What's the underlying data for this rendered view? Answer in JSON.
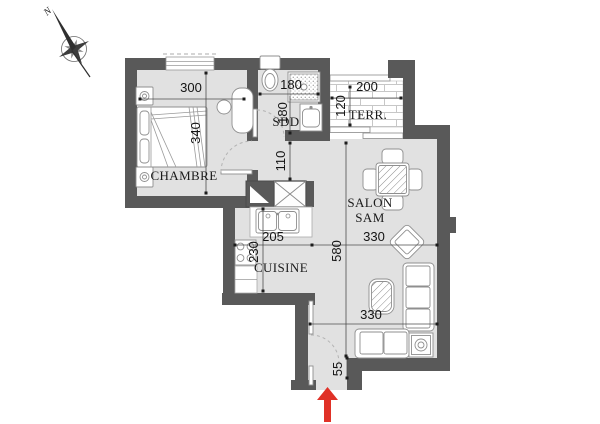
{
  "title": "apartment floor plan",
  "colors": {
    "wall": "#595959",
    "floor": "#e1e1e1",
    "fixture_stroke": "#8f8f8f",
    "dimension_text": "#141414",
    "entry_arrow": "#e03127"
  },
  "compass": {
    "north": "N"
  },
  "rooms": {
    "chambre": {
      "label": "CHAMBRE",
      "width_cm": "300",
      "height_cm": "340"
    },
    "sdd": {
      "label": "SDD",
      "width_cm": "180",
      "height_cm": "180"
    },
    "terrace": {
      "label": "TERR.",
      "width_cm": "200",
      "height_cm": "120"
    },
    "salon": {
      "label1": "SALON",
      "label2": "SAM",
      "height_cm": "580",
      "width_top_cm": "330",
      "width_bottom_cm": "330"
    },
    "cuisine": {
      "label": "CUISINE",
      "width_cm": "205",
      "height_cm": "230"
    },
    "hall": {
      "height_cm": "110"
    },
    "entry": {
      "depth_cm": "55"
    }
  }
}
